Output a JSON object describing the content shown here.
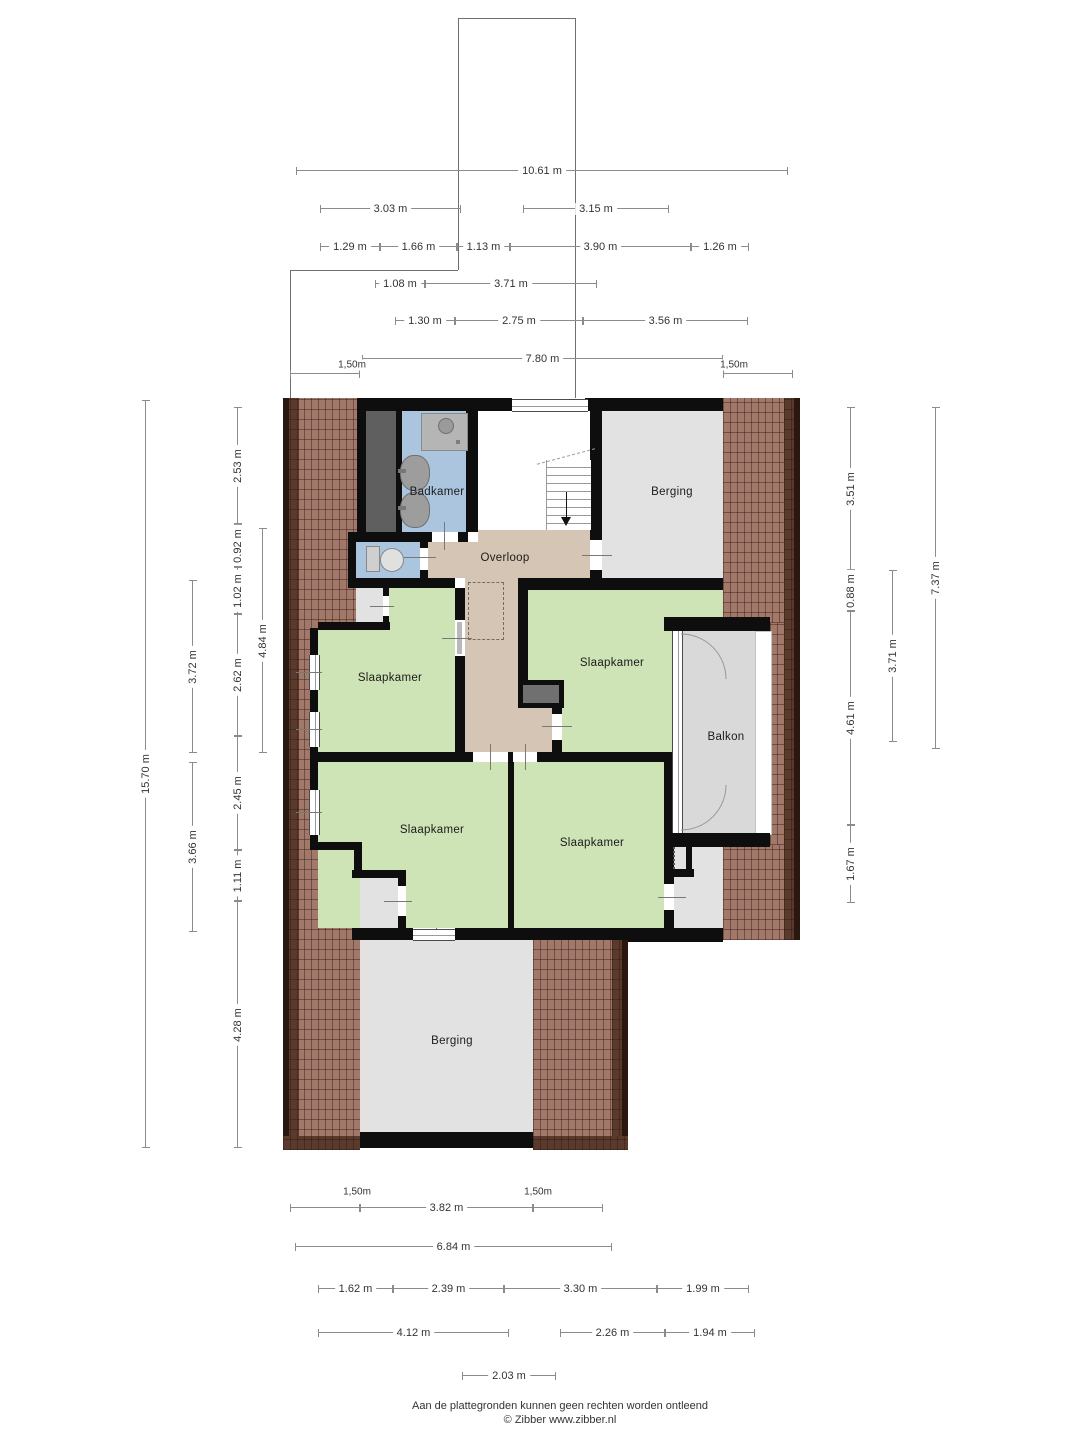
{
  "palette": {
    "wall": "#0e0e0e",
    "roof": "#a1786a",
    "roofdark": "#5a3a2c",
    "roofedge": "#2a1810",
    "green": "#cee3b6",
    "tan": "#d5c5b5",
    "blue": "#abc5de",
    "gray": "#e2e2e2",
    "void": "#5f5f5f",
    "deck": "#d9d9d9"
  },
  "rooms": {
    "badkamer": "Badkamer",
    "overloop": "Overloop",
    "berging_top": "Berging",
    "slaapkamer_tl": "Slaapkamer",
    "slaapkamer_tr": "Slaapkamer",
    "slaapkamer_bl": "Slaapkamer",
    "slaapkamer_br": "Slaapkamer",
    "balkon": "Balkon",
    "berging_bottom": "Berging"
  },
  "dims": {
    "top": [
      "10.61 m",
      "3.03 m",
      "3.15 m",
      "1.29 m",
      "1.66 m",
      "1.13 m",
      "3.90 m",
      "1.26 m",
      "1.08 m",
      "3.71 m",
      "1.30 m",
      "2.75 m",
      "3.56 m",
      "7.80 m",
      "1,50m",
      "1,50m"
    ],
    "left": [
      "15.70 m",
      "3.72 m",
      "3.66 m",
      "2.53 m",
      "0.92 m",
      "1.02 m",
      "2.62 m",
      "2.45 m",
      "1.11 m",
      "4.28 m",
      "4.84 m"
    ],
    "right": [
      "3.51 m",
      "0.88 m",
      "4.61 m",
      "1.67 m",
      "3.71 m",
      "7.37 m"
    ],
    "bottom": [
      "1,50m",
      "3.82 m",
      "1,50m",
      "6.84 m",
      "1.62 m",
      "2.39 m",
      "3.30 m",
      "1.99 m",
      "4.12 m",
      "2.26 m",
      "1.94 m",
      "2.03 m"
    ]
  },
  "footer": {
    "disclaimer": "Aan de plattegronden kunnen geen rechten worden ontleend",
    "credit": "© Zibber www.zibber.nl"
  }
}
